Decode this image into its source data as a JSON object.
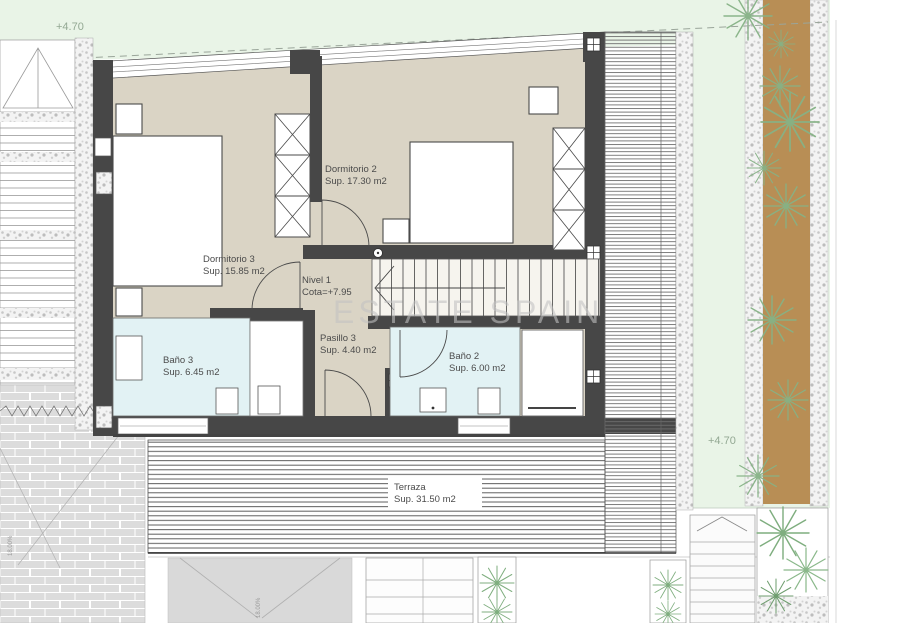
{
  "plan": {
    "watermark": "ESTATE SPAIN",
    "levels": {
      "top_left": "+4.70",
      "right": "+4.70"
    },
    "rooms": {
      "dormitorio2": {
        "name": "Dormitorio 2",
        "area": "Sup. 17.30 m2"
      },
      "dormitorio3": {
        "name": "Dormitorio 3",
        "area": "Sup. 15.85 m2"
      },
      "nivel1": {
        "name": "Nivel 1",
        "area": "Cota=+7.95"
      },
      "pasillo3": {
        "name": "Pasillo 3",
        "area": "Sup. 4.40 m2"
      },
      "bano3": {
        "name": "Baño 3",
        "area": "Sup. 6.45 m2"
      },
      "bano2": {
        "name": "Baño 2",
        "area": "Sup. 6.00 m2"
      },
      "terraza": {
        "name": "Terraza",
        "area": "Sup. 31.50 m2"
      }
    },
    "annotations": {
      "ramp_left": "18.00%",
      "ramp_center": "18.00%"
    },
    "colors": {
      "wall": "#474747",
      "floor": "#dad4c5",
      "bath": "#e2f2f4",
      "grass": "#e9f4e7",
      "path": "#b88e55",
      "watermark": "#c2c2c2"
    }
  }
}
